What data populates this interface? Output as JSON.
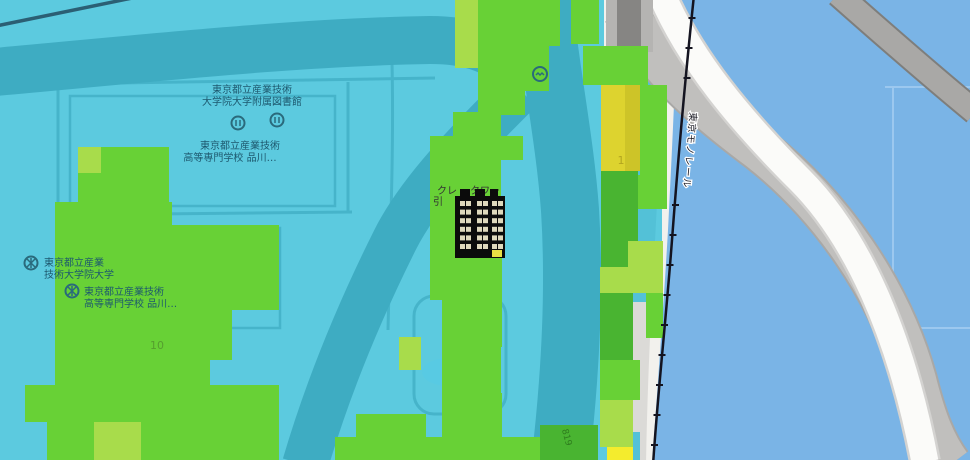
{
  "map": {
    "labels": {
      "library": {
        "line1": "東京都立産業技術",
        "line2": "大学院大学附属図書館"
      },
      "kosen_north": {
        "line1": "東京都立産業技術",
        "line2": "高等専門学校 品川…"
      },
      "aiit": {
        "line1": "東京都立産業",
        "line2": "技術大学院大学"
      },
      "kosen_south": {
        "line1": "東京都立産業技術",
        "line2": "高等専門学校 品川…"
      },
      "building": {
        "left": "クレ",
        "right": "タワー",
        "line2": "引"
      },
      "monorail": "東京モノレール",
      "road_small": "819"
    },
    "values": {
      "left_cell": "10",
      "right_cell": "1"
    },
    "colors": {
      "cyan_overlay": "rgba(0,178,215,0.62)",
      "water": "#7ab4e6",
      "ground": "#f2f1ed",
      "road_band_base": "#a3a2a0",
      "gray_road": "#c0bfbd",
      "white_road": "#fbfbf9",
      "monorail_line": "#141420",
      "label_text": "#1d586e"
    },
    "overlay_colors": {
      "g": "#68d136",
      "l": "#a8dc4b",
      "d": "#49b431",
      "y": "#ddd32f",
      "yd": "#cdc428",
      "yb": "#f4ec2d"
    },
    "overlay_cells": [
      {
        "x": 455,
        "y": 0,
        "w": 23,
        "h": 68,
        "c": "l"
      },
      {
        "x": 478,
        "y": 0,
        "w": 82,
        "h": 46,
        "c": "g"
      },
      {
        "x": 478,
        "y": 46,
        "w": 47,
        "h": 69,
        "c": "g"
      },
      {
        "x": 525,
        "y": 46,
        "w": 24,
        "h": 45,
        "c": "g"
      },
      {
        "x": 571,
        "y": 0,
        "w": 28,
        "h": 44,
        "c": "g"
      },
      {
        "x": 583,
        "y": 46,
        "w": 65,
        "h": 39,
        "c": "g"
      },
      {
        "x": 601,
        "y": 85,
        "w": 39,
        "h": 86,
        "c": "y"
      },
      {
        "x": 625,
        "y": 85,
        "w": 15,
        "h": 86,
        "c": "yd"
      },
      {
        "x": 640,
        "y": 85,
        "w": 27,
        "h": 90,
        "c": "g"
      },
      {
        "x": 601,
        "y": 171,
        "w": 37,
        "h": 96,
        "c": "d"
      },
      {
        "x": 638,
        "y": 175,
        "w": 29,
        "h": 34,
        "c": "g"
      },
      {
        "x": 628,
        "y": 241,
        "w": 35,
        "h": 52,
        "c": "l"
      },
      {
        "x": 600,
        "y": 267,
        "w": 28,
        "h": 26,
        "c": "l"
      },
      {
        "x": 600,
        "y": 293,
        "w": 33,
        "h": 67,
        "c": "d"
      },
      {
        "x": 646,
        "y": 293,
        "w": 17,
        "h": 45,
        "c": "g"
      },
      {
        "x": 600,
        "y": 360,
        "w": 40,
        "h": 40,
        "c": "g"
      },
      {
        "x": 600,
        "y": 400,
        "w": 33,
        "h": 47,
        "c": "l"
      },
      {
        "x": 607,
        "y": 447,
        "w": 26,
        "h": 13,
        "c": "yb"
      },
      {
        "x": 540,
        "y": 425,
        "w": 58,
        "h": 35,
        "c": "d"
      },
      {
        "x": 522,
        "y": 437,
        "w": 18,
        "h": 23,
        "c": "g"
      },
      {
        "x": 453,
        "y": 112,
        "w": 48,
        "h": 46,
        "c": "g"
      },
      {
        "x": 501,
        "y": 136,
        "w": 22,
        "h": 24,
        "c": "g"
      },
      {
        "x": 430,
        "y": 136,
        "w": 24,
        "h": 70,
        "c": "g"
      },
      {
        "x": 454,
        "y": 158,
        "w": 47,
        "h": 48,
        "c": "g"
      },
      {
        "x": 430,
        "y": 206,
        "w": 72,
        "h": 94,
        "c": "g"
      },
      {
        "x": 442,
        "y": 300,
        "w": 60,
        "h": 47,
        "c": "g"
      },
      {
        "x": 399,
        "y": 337,
        "w": 22,
        "h": 33,
        "c": "l"
      },
      {
        "x": 442,
        "y": 347,
        "w": 59,
        "h": 46,
        "c": "g"
      },
      {
        "x": 442,
        "y": 393,
        "w": 60,
        "h": 44,
        "c": "g"
      },
      {
        "x": 356,
        "y": 414,
        "w": 70,
        "h": 23,
        "c": "g"
      },
      {
        "x": 335,
        "y": 437,
        "w": 187,
        "h": 23,
        "c": "g"
      },
      {
        "x": 78,
        "y": 147,
        "w": 23,
        "h": 26,
        "c": "l"
      },
      {
        "x": 101,
        "y": 147,
        "w": 68,
        "h": 26,
        "c": "g"
      },
      {
        "x": 78,
        "y": 173,
        "w": 91,
        "h": 29,
        "c": "g"
      },
      {
        "x": 55,
        "y": 202,
        "w": 117,
        "h": 258,
        "c": "g"
      },
      {
        "x": 172,
        "y": 225,
        "w": 107,
        "h": 85,
        "c": "g"
      },
      {
        "x": 172,
        "y": 310,
        "w": 60,
        "h": 50,
        "c": "g"
      },
      {
        "x": 172,
        "y": 360,
        "w": 38,
        "h": 25,
        "c": "g"
      },
      {
        "x": 172,
        "y": 385,
        "w": 107,
        "h": 75,
        "c": "g"
      },
      {
        "x": 25,
        "y": 385,
        "w": 30,
        "h": 37,
        "c": "g"
      },
      {
        "x": 47,
        "y": 422,
        "w": 8,
        "h": 38,
        "c": "g"
      },
      {
        "x": 94,
        "y": 422,
        "w": 47,
        "h": 38,
        "c": "l"
      }
    ]
  }
}
